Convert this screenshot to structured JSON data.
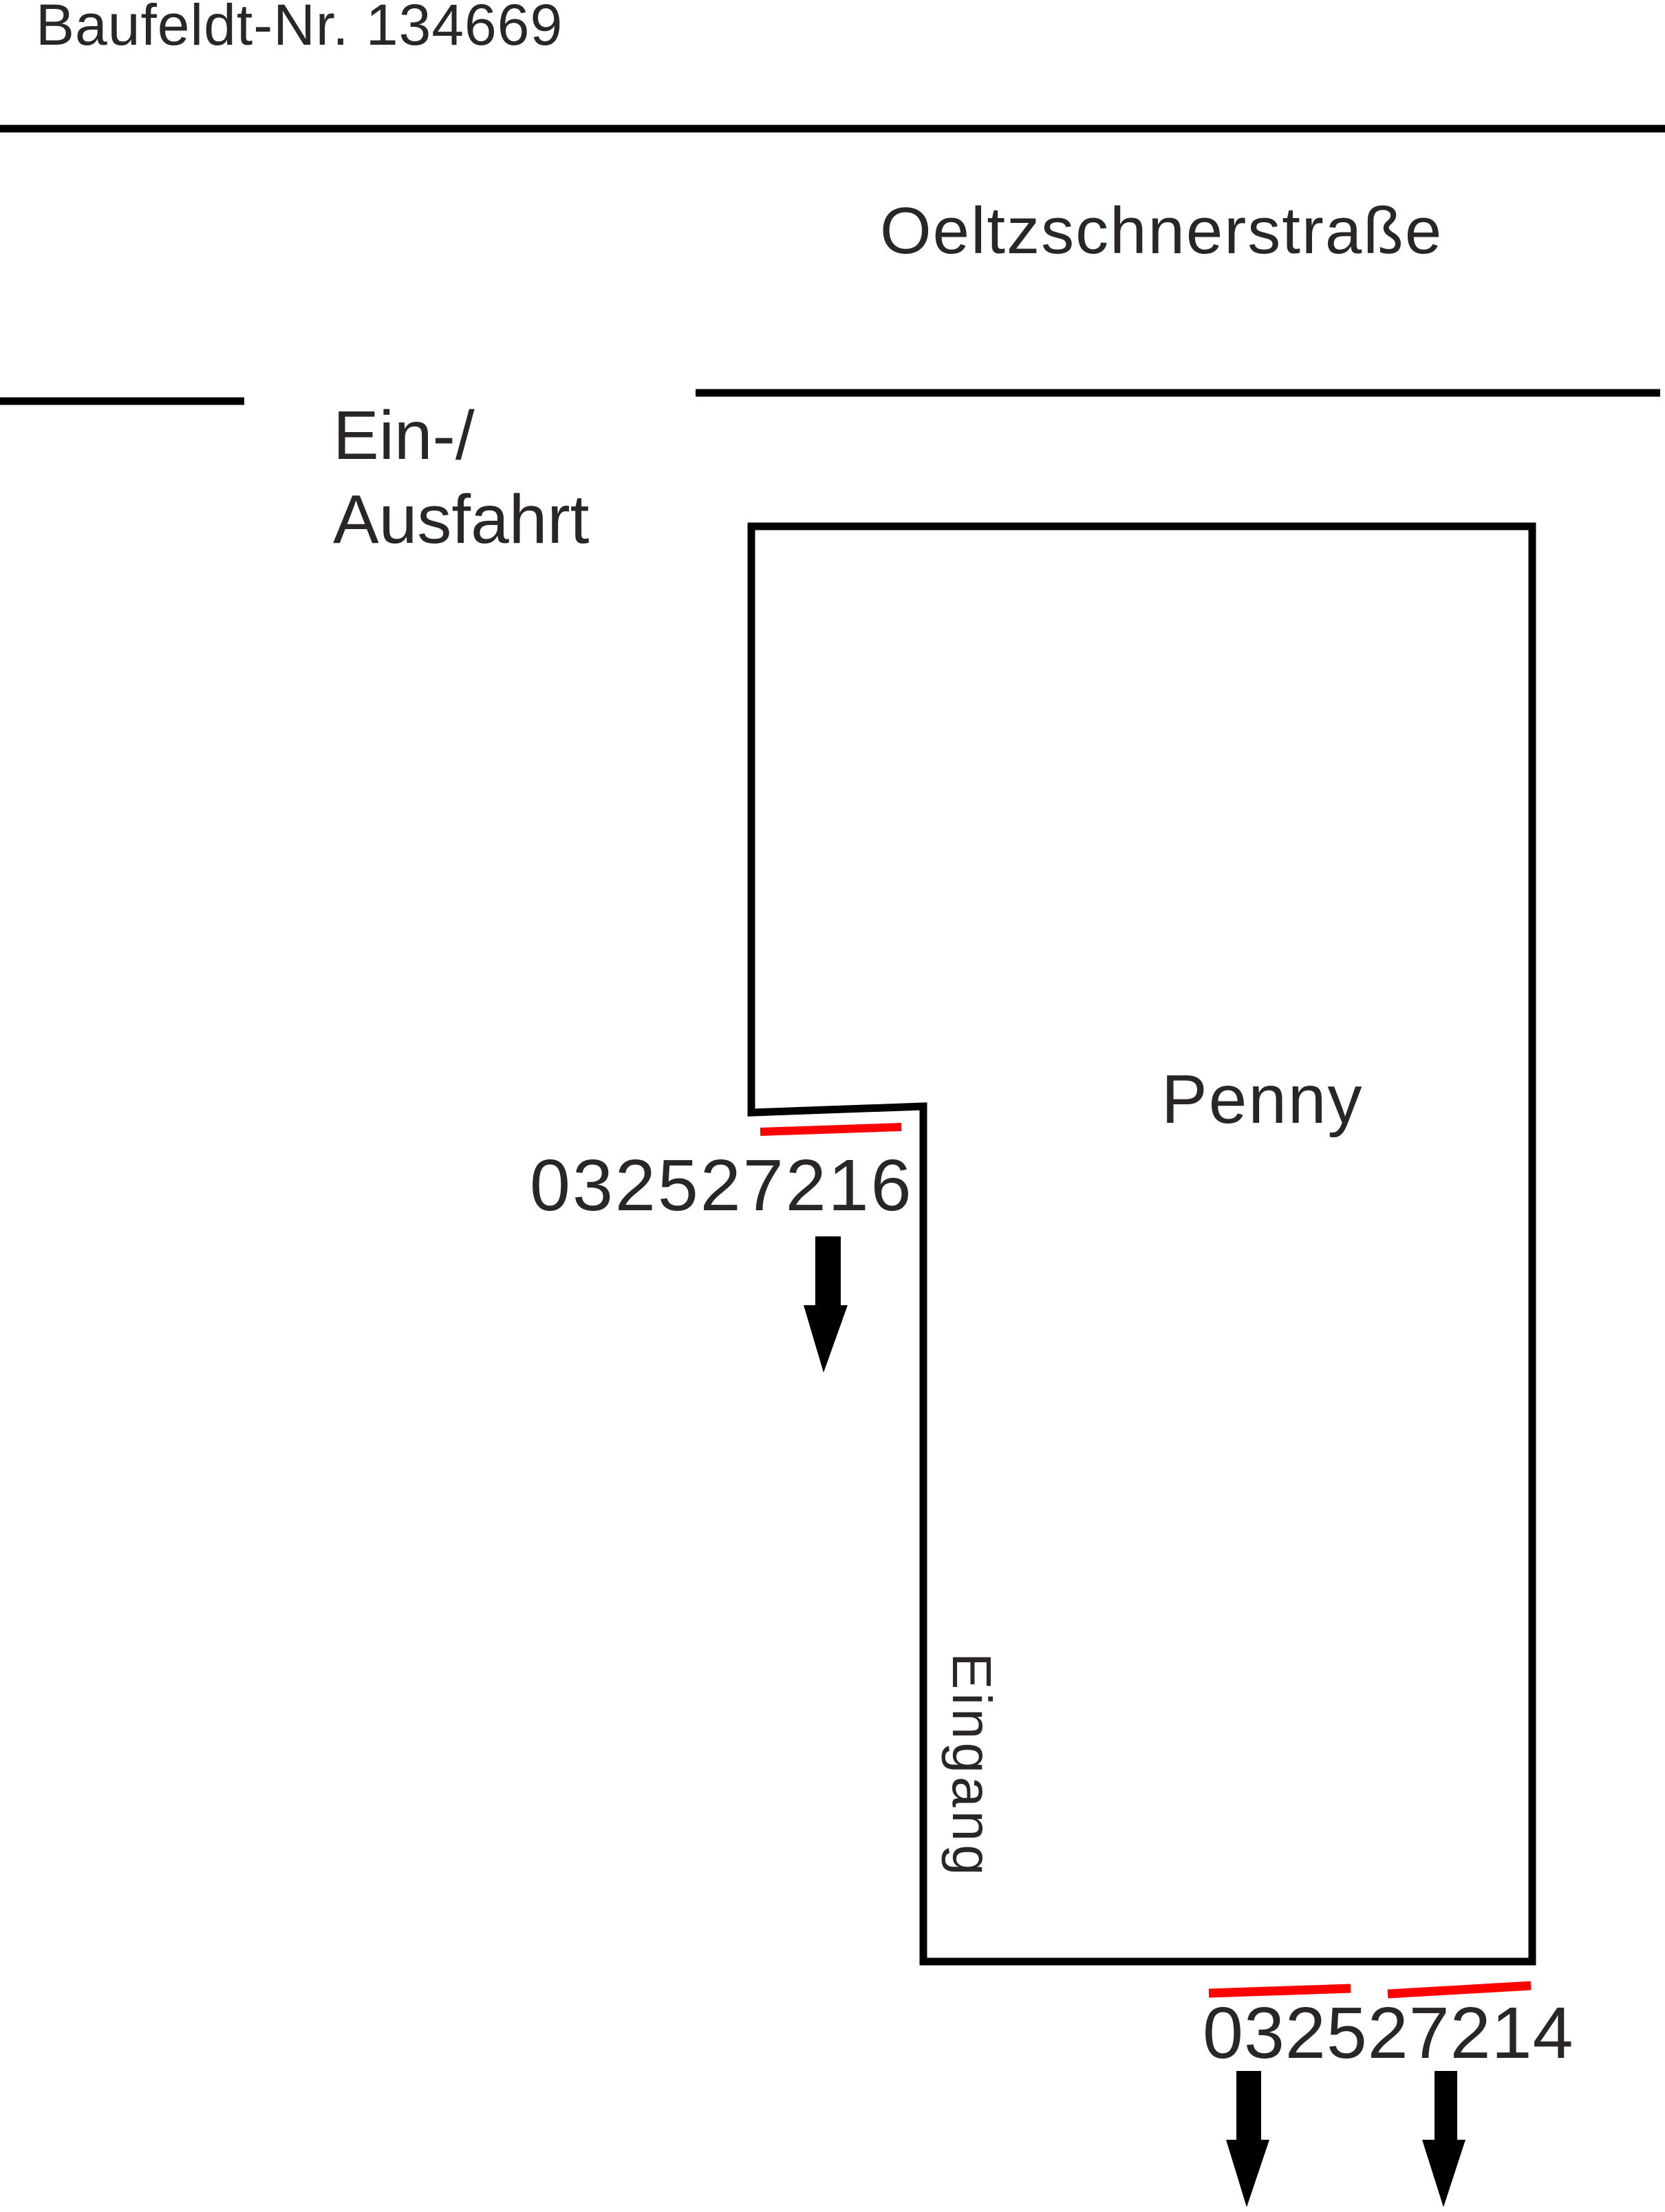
{
  "document": {
    "baufeld_label": "Baufeldt-Nr. 134669"
  },
  "plan": {
    "street_name": "Oeltzschnerstraße",
    "access_line1": "Ein-/",
    "access_line2": "Ausfahrt",
    "building_name": "Penny",
    "entrance_label": "Eingang",
    "upper_marker_id": "032527216",
    "lower_marker_id": "032527214"
  },
  "icons": {
    "down_arrow": "▼"
  },
  "colors": {
    "ink": "#000000",
    "text": "#2a2526",
    "highlight": "#ff0000"
  }
}
